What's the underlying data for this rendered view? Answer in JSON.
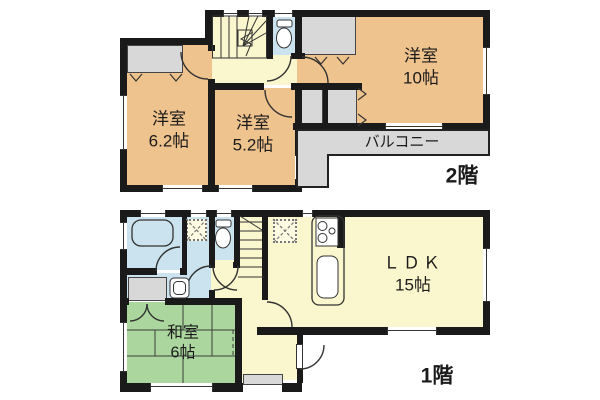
{
  "title": "間取り図",
  "colors": {
    "wall": "#1a1a1a",
    "western_room_fill": "#efc38d",
    "hall_fill": "#faf6cd",
    "water_area_fill": "#cbe3ee",
    "tatami_fill": "#abd79e",
    "closet_fill": "#d8d8d8",
    "outline": "#333333"
  },
  "floor2": {
    "label": "2階",
    "room_yoshitsu10": {
      "name": "洋室",
      "size": "10帖"
    },
    "room_yoshitsu62": {
      "name": "洋室",
      "size": "6.2帖"
    },
    "room_yoshitsu52": {
      "name": "洋室",
      "size": "5.2帖"
    },
    "balcony_label": "バルコニー"
  },
  "floor1": {
    "label": "1階",
    "room_ldk": {
      "name": "ＬＤＫ",
      "size": "15帖"
    },
    "room_washitsu": {
      "name": "和室",
      "size": "6帖"
    }
  }
}
